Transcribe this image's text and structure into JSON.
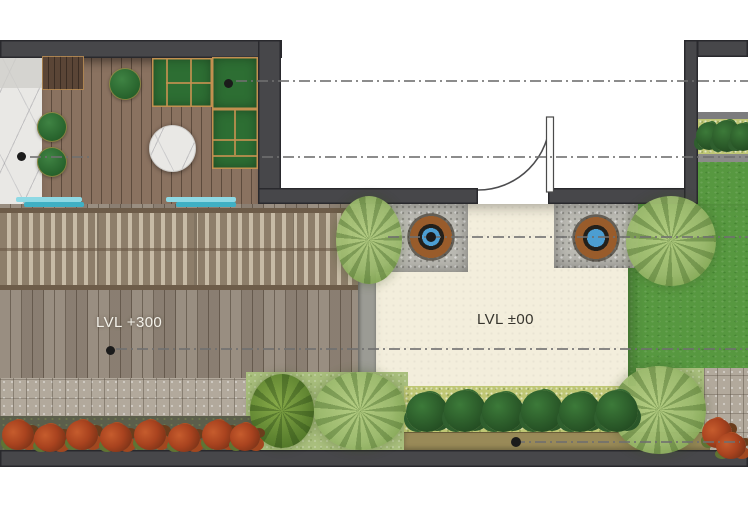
{
  "labels": {
    "deck_level": "LVL +300",
    "terrace_level": "LVL ±00"
  },
  "colors": {
    "wall": "#47474a",
    "deckMain": "#94887a",
    "roomDeck": "#8a7260",
    "cream": "#f3eedc",
    "lawn": "#579840",
    "teal": "#8ed9e4",
    "tealDark": "#3fb0c4",
    "marbleBase": "#e9e8e5",
    "gravel": "#bcbbb4",
    "potClay": "#995c2b",
    "potWater": "#4c9ed2",
    "sofaGreen": "#2d6e33",
    "sofaTrim": "#c29050",
    "hedgeGreen": "#234c22",
    "bedYellowGreen": "#bfc774",
    "tanStrip": "#998a58",
    "paver": "#b2a99c",
    "flowerRed": "#a9431f",
    "groundGreen": "#a9bf7d",
    "fernGreen": "#9cba6e",
    "centerline": "#6f6f6f"
  }
}
